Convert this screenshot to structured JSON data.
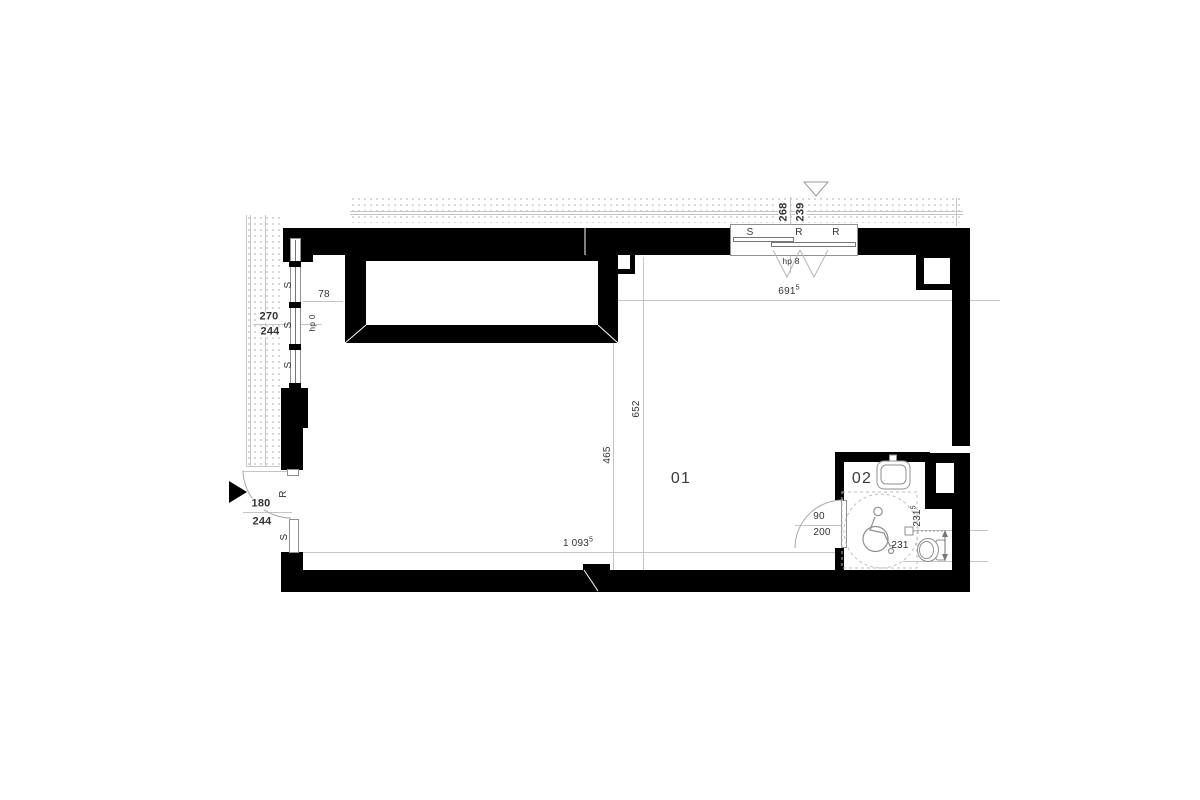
{
  "plan": {
    "rooms": {
      "main": "01",
      "bathroom": "02"
    },
    "left_window": {
      "width": "270",
      "height": "244",
      "offset": "78",
      "sill_height": "hp 0",
      "pane1": "S",
      "pane2": "S",
      "pane3": "S"
    },
    "entrance_door": {
      "width": "180",
      "height": "244",
      "leaf": "R",
      "side_panel": "S"
    },
    "top_window": {
      "pane1": "S",
      "pane2": "R",
      "pane3": "R",
      "dim_left": "268",
      "dim_right": "239",
      "sill_height": "hp 8"
    },
    "bathroom_door": {
      "width": "90",
      "height": "200"
    },
    "dimensions": {
      "room_width": {
        "value": "691",
        "sup": "5"
      },
      "room_depth": "652",
      "room_depth_lower": "465",
      "bottom_width": {
        "value": "1 093",
        "sup": "5"
      },
      "wc_clearance_side": {
        "value": "231",
        "sup": "5"
      },
      "wc_clearance_front": "231"
    },
    "colors": {
      "wall": "#000000",
      "hairline": "#c5c5c5",
      "text": "#333333"
    }
  }
}
